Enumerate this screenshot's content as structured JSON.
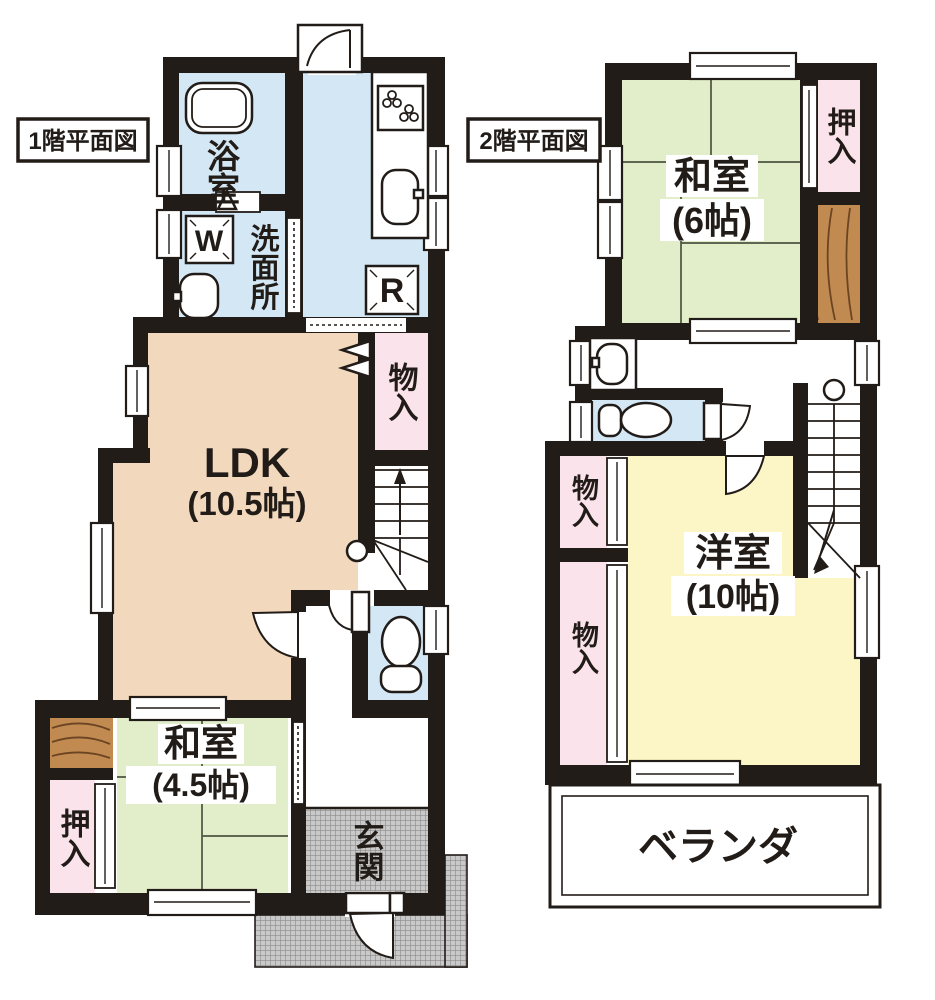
{
  "floor1": {
    "title": "1階平面図",
    "bathroom": "浴室",
    "washroom": "洗面所",
    "washer": "W",
    "fridge": "R",
    "ldk": "LDK",
    "ldk_size": "(10.5帖)",
    "storage": "物入",
    "japanese_room": "和室",
    "japanese_room_size": "(4.5帖)",
    "closet": "押入",
    "entrance": "玄関"
  },
  "floor2": {
    "title": "2階平面図",
    "japanese_room": "和室",
    "japanese_room_size": "(6帖)",
    "closet": "押入",
    "storage_upper": "物入",
    "storage_lower": "物入",
    "western_room": "洋室",
    "western_room_size": "(10帖)",
    "veranda": "ベランダ"
  },
  "colors": {
    "wall": "#221c18",
    "water_blue": "#d3e7f5",
    "ldk_beige": "#f2d8bc",
    "tatami_green": "#e2eeca",
    "western_yellow": "#fcf6c6",
    "closet_pink": "#fae3eb",
    "wood": "#c18a50",
    "hatch_gray": "#c9c9c9"
  }
}
